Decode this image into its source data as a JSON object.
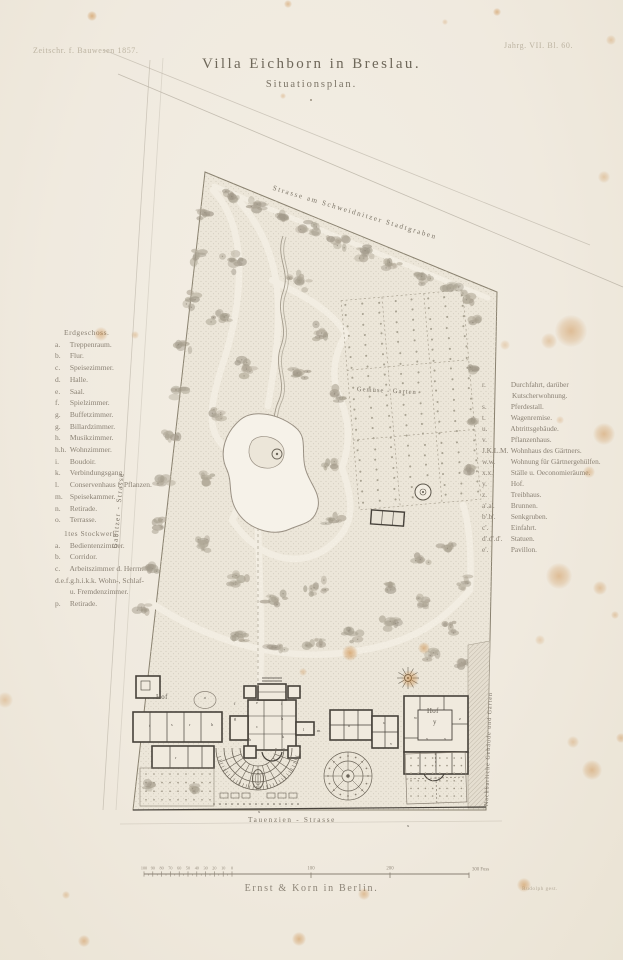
{
  "plate": {
    "journal_ref": "Zeitschr. f. Bauwesen 1857.",
    "issue_ref": "Jahrg. VII. Bl. 60.",
    "title": "Villa Eichborn in Breslau.",
    "subtitle": "Situationsplan.",
    "publisher": "Ernst & Korn in Berlin.",
    "engraver": "Rudolph gest."
  },
  "plan": {
    "street_top": "Strasse am Schweidnitzer Stadtgraben",
    "street_left": "Gabitzer - Strasse",
    "street_bottom": "Tauenzien - Strasse",
    "neighbor_strip": "Nachbarliche Gebäude und Garten",
    "kitchen_garden": "Gemüse - Garten",
    "courtyard_left": "Hof",
    "courtyard_right_label": "Hof",
    "courtyard_right_key": "y",
    "room_letters": [
      {
        "t": "f",
        "x": 234,
        "y": 705
      },
      {
        "t": "e",
        "x": 256,
        "y": 704
      },
      {
        "t": "i",
        "x": 281,
        "y": 705
      },
      {
        "t": "g",
        "x": 234,
        "y": 720
      },
      {
        "t": "h",
        "x": 281,
        "y": 720
      },
      {
        "t": "c",
        "x": 256,
        "y": 728
      },
      {
        "t": "b",
        "x": 249,
        "y": 741
      },
      {
        "t": "k",
        "x": 282,
        "y": 738
      },
      {
        "t": "l",
        "x": 303,
        "y": 731
      },
      {
        "t": "m",
        "x": 317,
        "y": 732
      },
      {
        "t": "h",
        "x": 211,
        "y": 726
      },
      {
        "t": "r",
        "x": 189,
        "y": 726
      },
      {
        "t": "s",
        "x": 171,
        "y": 726
      },
      {
        "t": "t",
        "x": 149,
        "y": 727
      },
      {
        "t": "r",
        "x": 175,
        "y": 759
      },
      {
        "t": "o",
        "x": 204,
        "y": 699
      },
      {
        "t": "n",
        "x": 348,
        "y": 727
      },
      {
        "t": "u",
        "x": 383,
        "y": 724
      },
      {
        "t": "w",
        "x": 414,
        "y": 719
      },
      {
        "t": "x",
        "x": 426,
        "y": 740
      },
      {
        "t": "x",
        "x": 444,
        "y": 740
      },
      {
        "t": "z",
        "x": 459,
        "y": 720
      },
      {
        "t": "v",
        "x": 390,
        "y": 745
      },
      {
        "t": "x",
        "x": 258,
        "y": 813
      },
      {
        "t": "x",
        "x": 407,
        "y": 827
      }
    ]
  },
  "legend": {
    "ground_floor": {
      "title": "Erdgeschoss.",
      "items": [
        {
          "key": "a.",
          "label": "Treppenraum."
        },
        {
          "key": "b.",
          "label": "Flur."
        },
        {
          "key": "c.",
          "label": "Speisezimmer."
        },
        {
          "key": "d.",
          "label": "Halle."
        },
        {
          "key": "e.",
          "label": "Saal."
        },
        {
          "key": "f.",
          "label": "Spielzimmer."
        },
        {
          "key": "g.",
          "label": "Buffetzimmer."
        },
        {
          "key": "g.",
          "label": "Billardzimmer."
        },
        {
          "key": "h.",
          "label": "Musikzimmer."
        },
        {
          "key": "h.h.",
          "label": "Wohnzimmer."
        },
        {
          "key": "i.",
          "label": "Boudoir."
        },
        {
          "key": "k.",
          "label": "Verbindungsgang."
        },
        {
          "key": "l.",
          "label": "Conservenhaus f. Pflanzen."
        },
        {
          "key": "m.",
          "label": "Speisekammer."
        },
        {
          "key": "n.",
          "label": "Retirade."
        },
        {
          "key": "o.",
          "label": "Terrasse."
        }
      ]
    },
    "first_floor": {
      "title": "1tes Stockwerk.",
      "items": [
        {
          "key": "a.",
          "label": "Bedientenzimmer."
        },
        {
          "key": "b.",
          "label": "Corridor."
        },
        {
          "key": "c.",
          "label": "Arbeitszimmer d. Herrn."
        },
        {
          "key": "d.e.f.g.h.i.k.k.",
          "label": "Wohn-, Schlaf-"
        },
        {
          "key": "",
          "label": "u. Fremdenzimmer."
        },
        {
          "key": "p.",
          "label": "Retirade."
        }
      ]
    },
    "site": {
      "items": [
        {
          "key": "r.",
          "label": "Durchfahrt, darüber Kutscherwohnung."
        },
        {
          "key": "s.",
          "label": "Pferdestall."
        },
        {
          "key": "t.",
          "label": "Wagenremise."
        },
        {
          "key": "u.",
          "label": "Abtrittsgebäude."
        },
        {
          "key": "v.",
          "label": "Pflanzenhaus."
        },
        {
          "key": "J.K.L.M.",
          "label": "Wohnhaus des Gärtners."
        },
        {
          "key": "w.w.",
          "label": "Wohnung für Gärtnergehülfen."
        },
        {
          "key": "x.x.",
          "label": "Ställe u. Oeconomieräume."
        },
        {
          "key": "y.",
          "label": "Hof."
        },
        {
          "key": "z.",
          "label": "Treibhaus."
        },
        {
          "key": "a'.a'.",
          "label": "Brunnen."
        },
        {
          "key": "b'.b'.",
          "label": "Senkgruben."
        },
        {
          "key": "c'.",
          "label": "Einfahrt."
        },
        {
          "key": "d'.d'.d'.",
          "label": "Statuen."
        },
        {
          "key": "e'.",
          "label": "Pavillon."
        }
      ]
    }
  },
  "scalebar": {
    "minor_labels": [
      "100",
      "90",
      "80",
      "70",
      "60",
      "50",
      "40",
      "30",
      "20",
      "10",
      "0"
    ],
    "major_labels": [
      "100",
      "200"
    ],
    "end_label": "300 Fuss"
  }
}
